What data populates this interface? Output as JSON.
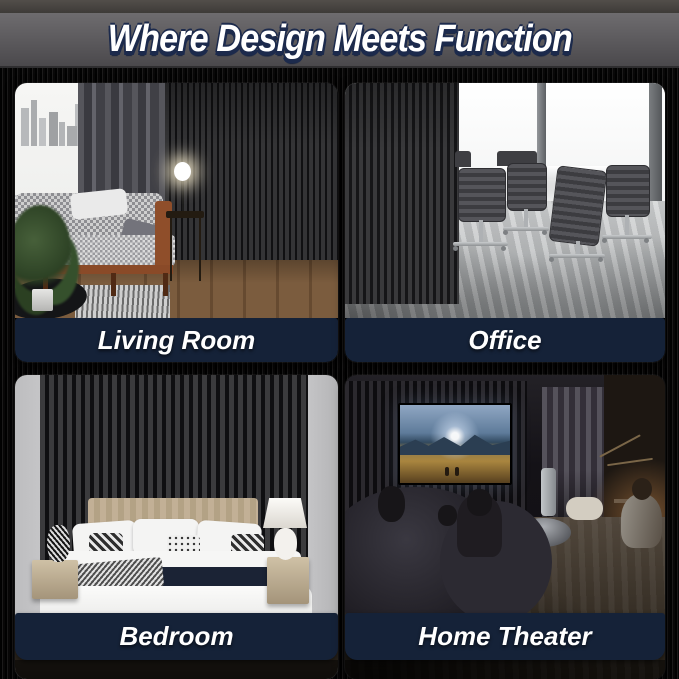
{
  "header": {
    "title": "Where Design Meets Function"
  },
  "tiles": [
    {
      "id": "living-room",
      "label": "Living Room"
    },
    {
      "id": "office",
      "label": "Office"
    },
    {
      "id": "bedroom",
      "label": "Bedroom"
    },
    {
      "id": "home-theater",
      "label": "Home Theater"
    }
  ],
  "colors": {
    "label_bar_navy": "#152238",
    "label_text": "#ffffff",
    "title_text": "#ffffff",
    "title_shadow_navy": "#1c2a4c",
    "topbar_gray": "#59575a",
    "background_black": "#070707"
  }
}
